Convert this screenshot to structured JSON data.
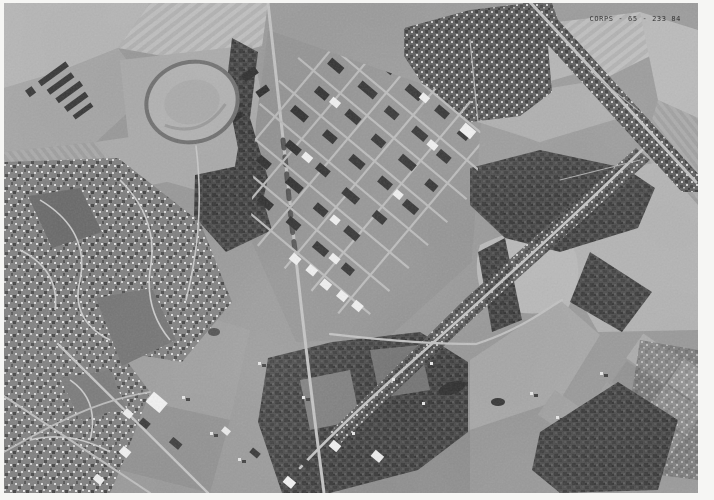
{
  "photo_annotation": {
    "id_label": "CORPS - 65 - 233 84"
  },
  "palette": {
    "page_margin": "#f6f6f4",
    "photo_base": "#969696",
    "field_light": "#b3b3b3",
    "woods_dark": "#454545",
    "road_light": "#c2c2c2",
    "building_dark": "#2d2d2d",
    "building_white": "#f0f0f0",
    "annotation_text": "#262626"
  }
}
